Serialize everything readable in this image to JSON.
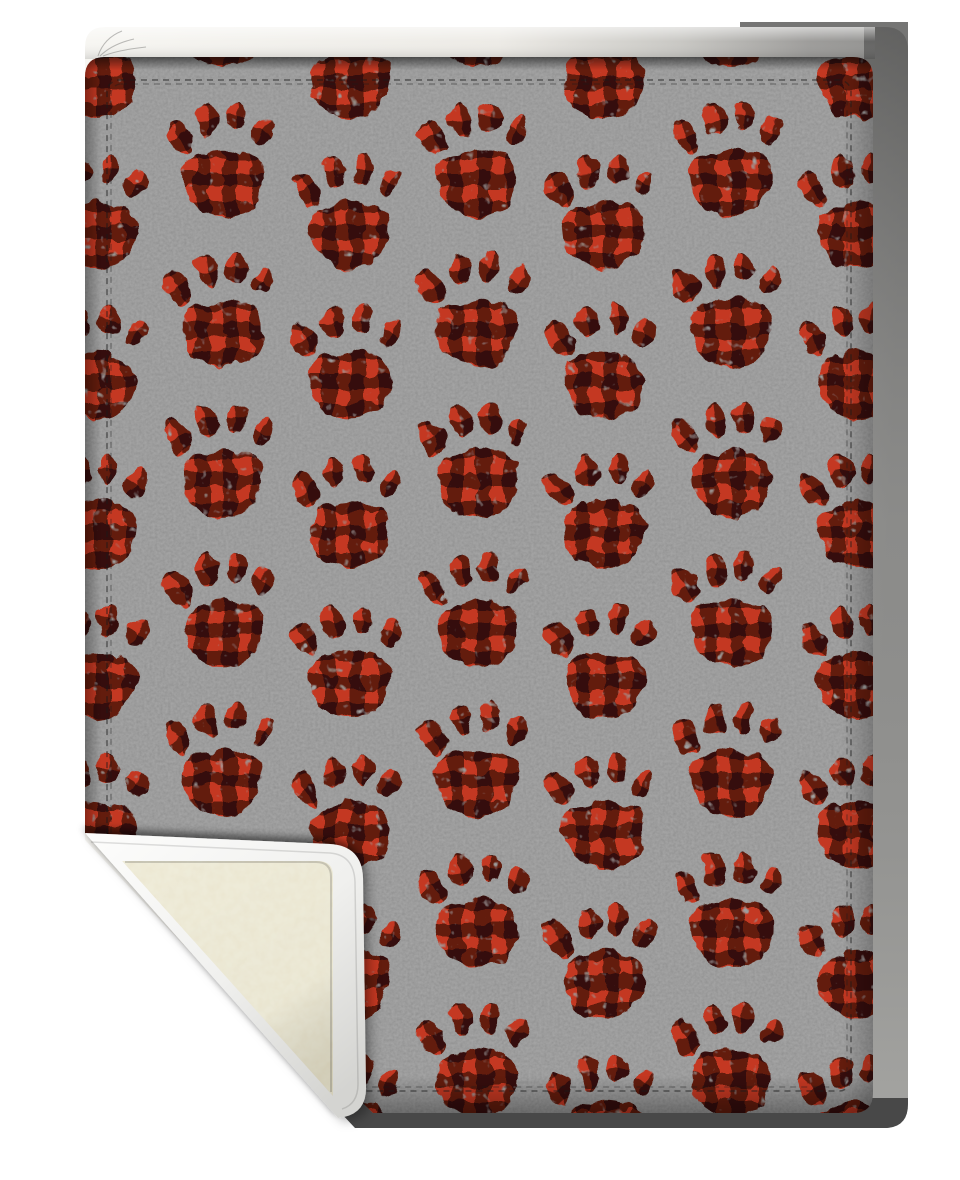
{
  "image": {
    "type": "product-mockup-photo",
    "subject": "sherpa fleece blanket, gray with red and black buffalo plaid paw prints, bottom-left corner folded up showing cream sherpa lining",
    "background_color": "#ffffff"
  },
  "colors": {
    "page_bg": "#ffffff",
    "fleece_gray": "#8c8c8c",
    "plaid_red": "#c43824",
    "plaid_shade": "rgba(12,3,0,0.52)",
    "sherpa_cream": "#f0edda",
    "binding_white": "#fbfbfa",
    "back_white": "#f6f5f1",
    "back_gray": "#8f8f8d",
    "shadow_dark": "#484848",
    "step_gray": "#757574",
    "stitch": "rgba(25,25,25,0.55)",
    "stitch_light": "rgba(25,25,25,0.38)"
  },
  "paw_grid": {
    "columns_x": [
      96,
      223,
      350,
      477,
      604,
      731,
      858
    ],
    "row_spacing": 150,
    "phase_even_y0": 75,
    "phase_odd_y0": 23,
    "y_max": 1135,
    "check_size": 28
  }
}
